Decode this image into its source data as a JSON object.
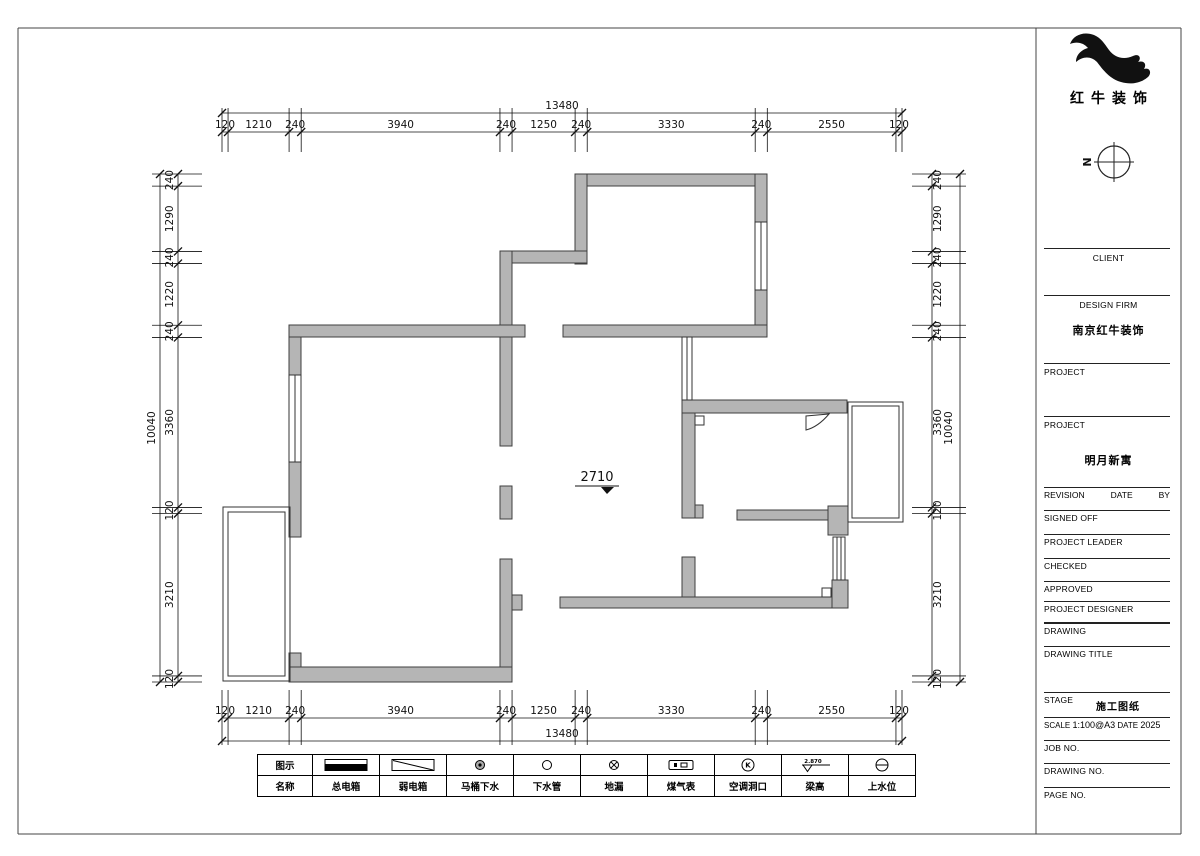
{
  "branding": {
    "logo_text": "红牛装饰",
    "north_label": "N"
  },
  "plan": {
    "total_width": 13480,
    "total_height": 10040,
    "overall_width_label": "13480",
    "overall_height_label": "10040",
    "dims_top": [
      120,
      1210,
      240,
      3940,
      240,
      1250,
      240,
      3330,
      240,
      2550,
      120
    ],
    "dims_bottom": [
      120,
      1210,
      240,
      3940,
      240,
      1250,
      240,
      3330,
      240,
      2550,
      120
    ],
    "dims_left": [
      240,
      1290,
      240,
      1220,
      240,
      3360,
      120,
      3210,
      120
    ],
    "dims_right": [
      240,
      1290,
      240,
      1220,
      240,
      3360,
      120,
      3210,
      120
    ],
    "floor_marker": "2710"
  },
  "legend": {
    "row1_header": "图示",
    "row2_header": "名称",
    "items": [
      {
        "name": "总电箱"
      },
      {
        "name": "弱电箱"
      },
      {
        "name": "马桶下水"
      },
      {
        "name": "下水管"
      },
      {
        "name": "地漏"
      },
      {
        "name": "煤气表"
      },
      {
        "name": "空调洞口",
        "glyph": "K"
      },
      {
        "name": "梁高",
        "value": "2.870"
      },
      {
        "name": "上水位"
      }
    ]
  },
  "title_block": {
    "client_label": "CLIENT",
    "design_firm_label": "DESIGN FIRM",
    "design_firm_value": "南京红牛装饰",
    "project1_label": "PROJECT",
    "project2_label": "PROJECT",
    "project_value": "明月新寓",
    "revision_label": "REVISION",
    "date_label": "DATE",
    "by_label": "BY",
    "signed_off_label": "SIGNED OFF",
    "project_leader_label": "PROJECT LEADER",
    "checked_label": "CHECKED",
    "approved_label": "APPROVED",
    "project_designer_label": "PROJECT DESIGNER",
    "drawing_label": "DRAWING",
    "drawing_title_label": "DRAWING TITLE",
    "stage_label": "STAGE",
    "stage_value": "施工图纸",
    "scale_label": "SCALE",
    "scale_value": "1:100@A3",
    "date2_label": "DATE",
    "date_value": "2025",
    "job_no_label": "JOB NO.",
    "drawing_no_label": "DRAWING NO.",
    "page_no_label": "PAGE NO."
  },
  "colors": {
    "wall_fill": "#b5b5b5",
    "wall_stroke": "#3f3f3f",
    "line": "#000000"
  }
}
